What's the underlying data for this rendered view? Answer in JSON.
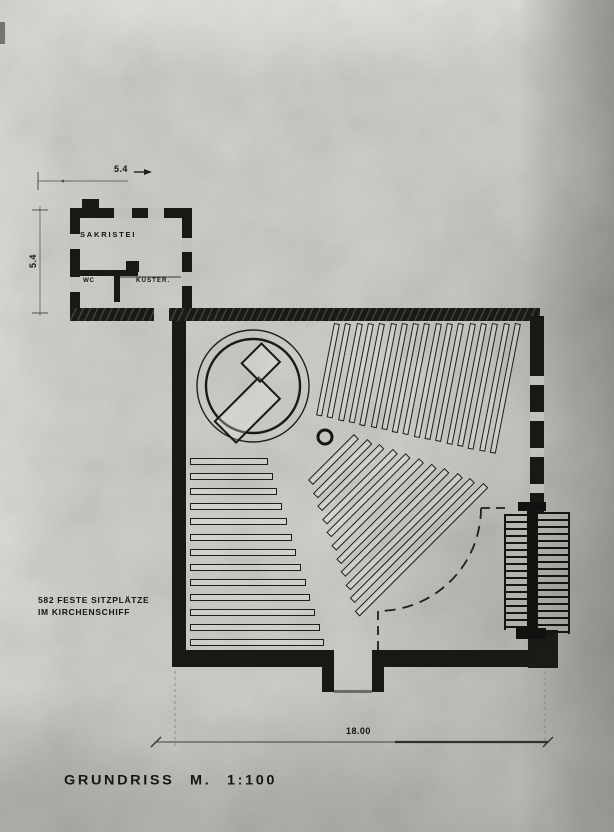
{
  "document": {
    "title": "GRUNDRISS M. 1:100"
  },
  "annotations": {
    "seats_line1": "582 FESTE SITZPLÄTZE",
    "seats_line2": "IM KIRCHENSCHIFF"
  },
  "rooms": {
    "sacristy": "SAKRISTEI",
    "wc": "WC",
    "sexton": "KÜSTER."
  },
  "dimensions": {
    "top_width": "5.4",
    "left_height": "5.4",
    "bottom_width": "18.00"
  },
  "drawing": {
    "type": "church floor plan, scanned photograph",
    "scale": "1:100",
    "ink_color": "#1b1a17",
    "paper_color": "#d9d8d3"
  }
}
